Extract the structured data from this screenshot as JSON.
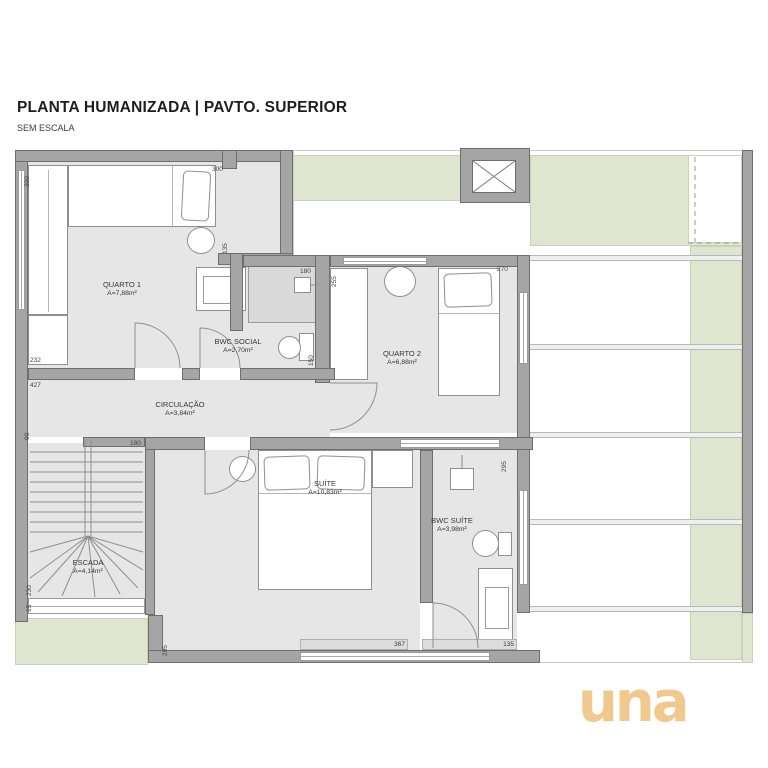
{
  "header": {
    "title": "PLANTA HUMANIZADA | PAVTO. SUPERIOR",
    "subtitle": "SEM ESCALA"
  },
  "rooms": {
    "quarto1": {
      "name": "QUARTO 1",
      "area": "A=7,88m²"
    },
    "bwc_social": {
      "name": "BWC SOCIAL",
      "area": "A=2,70m²"
    },
    "quarto2": {
      "name": "QUARTO 2",
      "area": "A=6,88m²"
    },
    "circulacao": {
      "name": "CIRCULAÇÃO",
      "area": "A=3,84m²"
    },
    "suite": {
      "name": "SUÍTE",
      "area": "A=10,83m²"
    },
    "bwc_suite": {
      "name": "BWC SUÍTE",
      "area": "A=3,98m²"
    },
    "escada": {
      "name": "ESCADA",
      "area": "A=4,14m²"
    }
  },
  "dims": {
    "left_300": "300",
    "q1_top_300": "300",
    "q1_135": "135",
    "q1_232": "232",
    "bwc_180": "180",
    "bwc_150": "150",
    "q2_255": "255",
    "q2_270": "270",
    "circ_427": "427",
    "circ_90": "90",
    "stairs_180": "180",
    "stairs_230": "230",
    "stairs_15": "15",
    "suite_295": "295",
    "suite_367": "367",
    "bwcsuite_295": "295",
    "bwcsuite_135": "135"
  },
  "logo": {
    "text": "una"
  },
  "colors": {
    "wall": "#a5a5a5",
    "floor": "#e6e6e6",
    "green_area": "#dfe6d0",
    "logo_tan": "#f1c88d"
  }
}
